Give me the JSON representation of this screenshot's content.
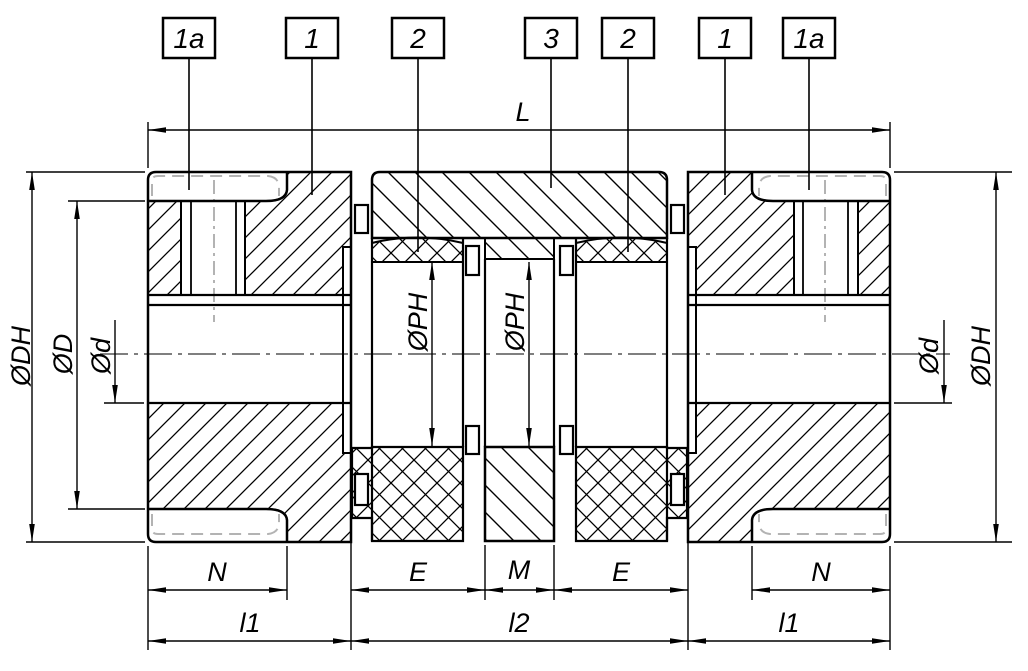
{
  "drawing": {
    "callouts": [
      {
        "label": "1a"
      },
      {
        "label": "1"
      },
      {
        "label": "2"
      },
      {
        "label": "3"
      },
      {
        "label": "2"
      },
      {
        "label": "1"
      },
      {
        "label": "1a"
      }
    ],
    "dimensions": {
      "overall_length": "L",
      "outer_diameter": "ØDH",
      "hub_flange_diameter": "ØD",
      "bore_diameter": "Ød",
      "bush_bore_diameter": "ØPH",
      "recess_length": "N",
      "element_length": "E",
      "middle_gap": "M",
      "hub_length": "l1",
      "center_section_length": "l2"
    },
    "colors": {
      "line": "#000000",
      "background": "#ffffff",
      "centerline_gray": "#b3b3b3"
    }
  }
}
